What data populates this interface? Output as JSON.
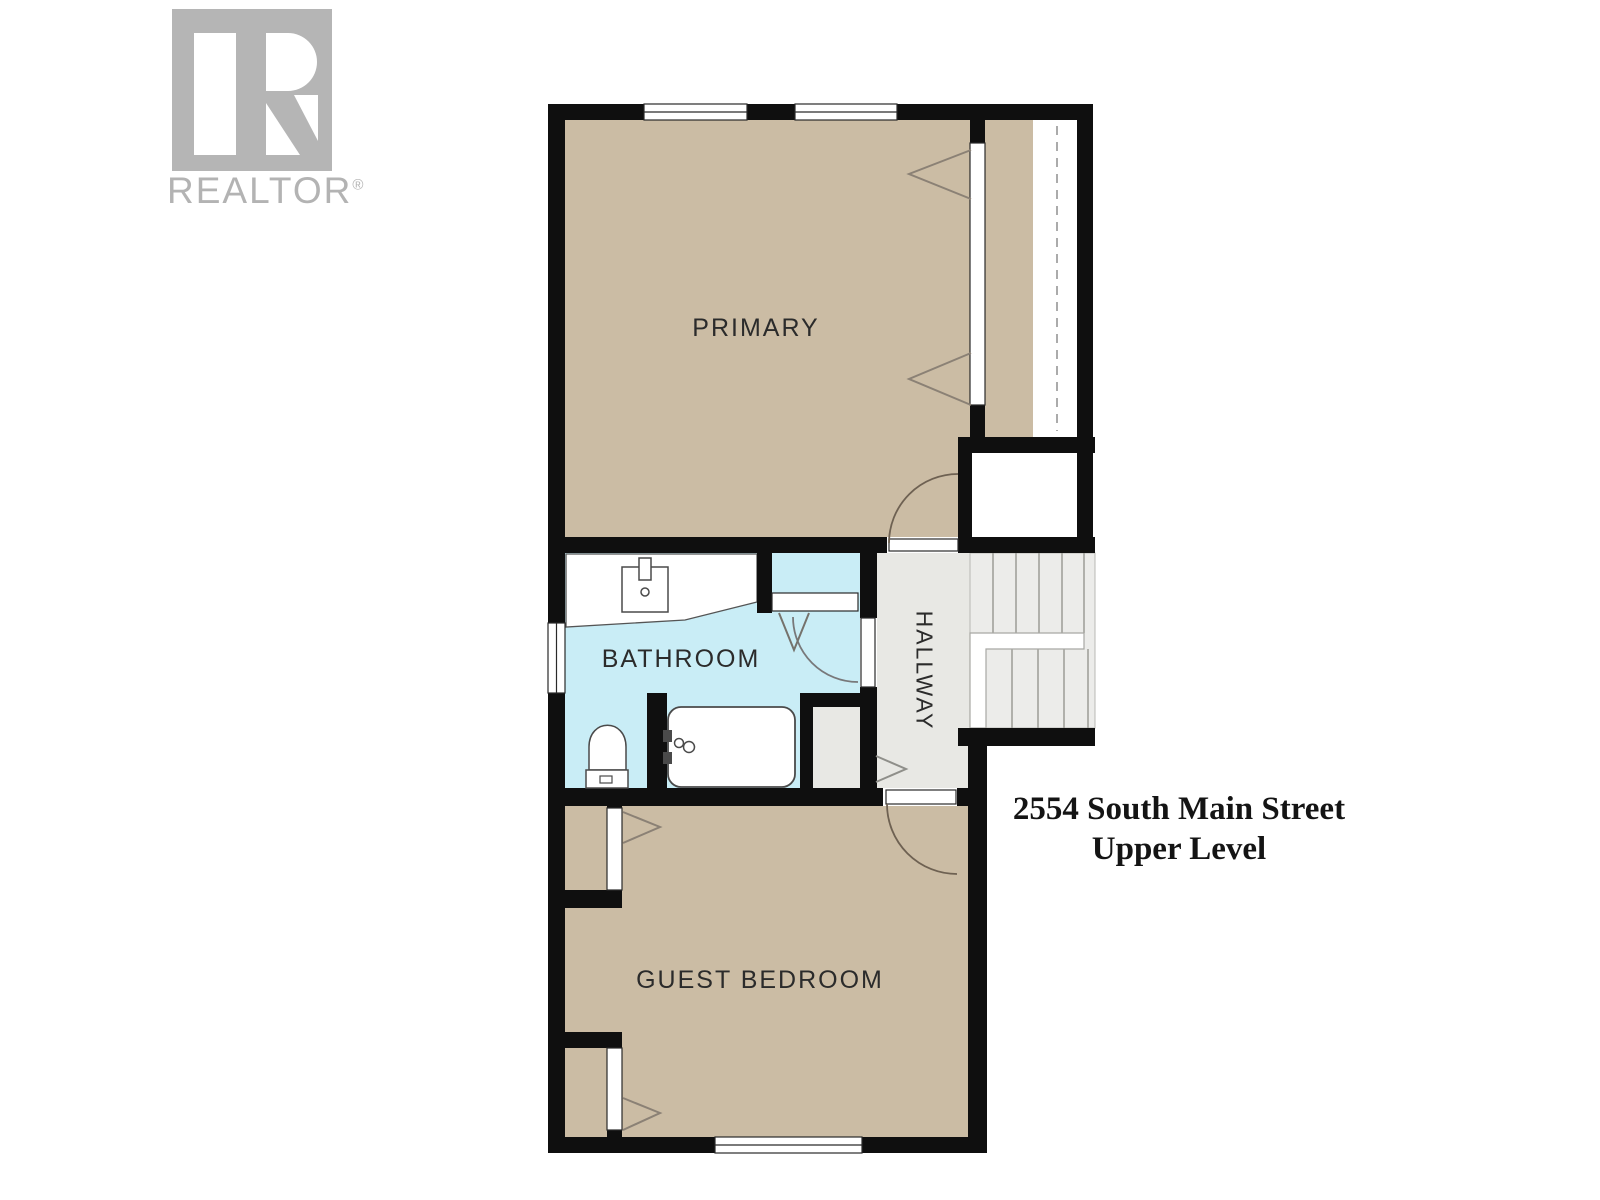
{
  "watermark": {
    "brand": "REALTOR",
    "registered_mark": "®",
    "logo_color": "#b5b5b5"
  },
  "plan_title": {
    "line1": "2554 South Main Street",
    "line2": "Upper Level"
  },
  "rooms": {
    "primary": {
      "label": "PRIMARY"
    },
    "bathroom": {
      "label": "BATHROOM"
    },
    "hallway": {
      "label": "HALLWAY"
    },
    "guest_bedroom": {
      "label": "GUEST BEDROOM"
    }
  },
  "fixtures": [
    "vanity-sink",
    "toilet",
    "bathtub"
  ],
  "architecture": {
    "windows": 4,
    "hinged_doors": 3,
    "bifold_doors": 5,
    "closets": 4,
    "staircase": "u-shaped switchback",
    "closet_rod": "dashed line"
  },
  "colors": {
    "room_floor_tan": "#cbbca4",
    "bathroom_floor_blue": "#c9edf6",
    "hallway_floor_gray": "#e8e8e4",
    "stairs_gray": "#ececea",
    "wall_black": "#0f0f0f",
    "door_arc_brown": "#6e6152",
    "watermark_gray": "#b3b3b3"
  }
}
